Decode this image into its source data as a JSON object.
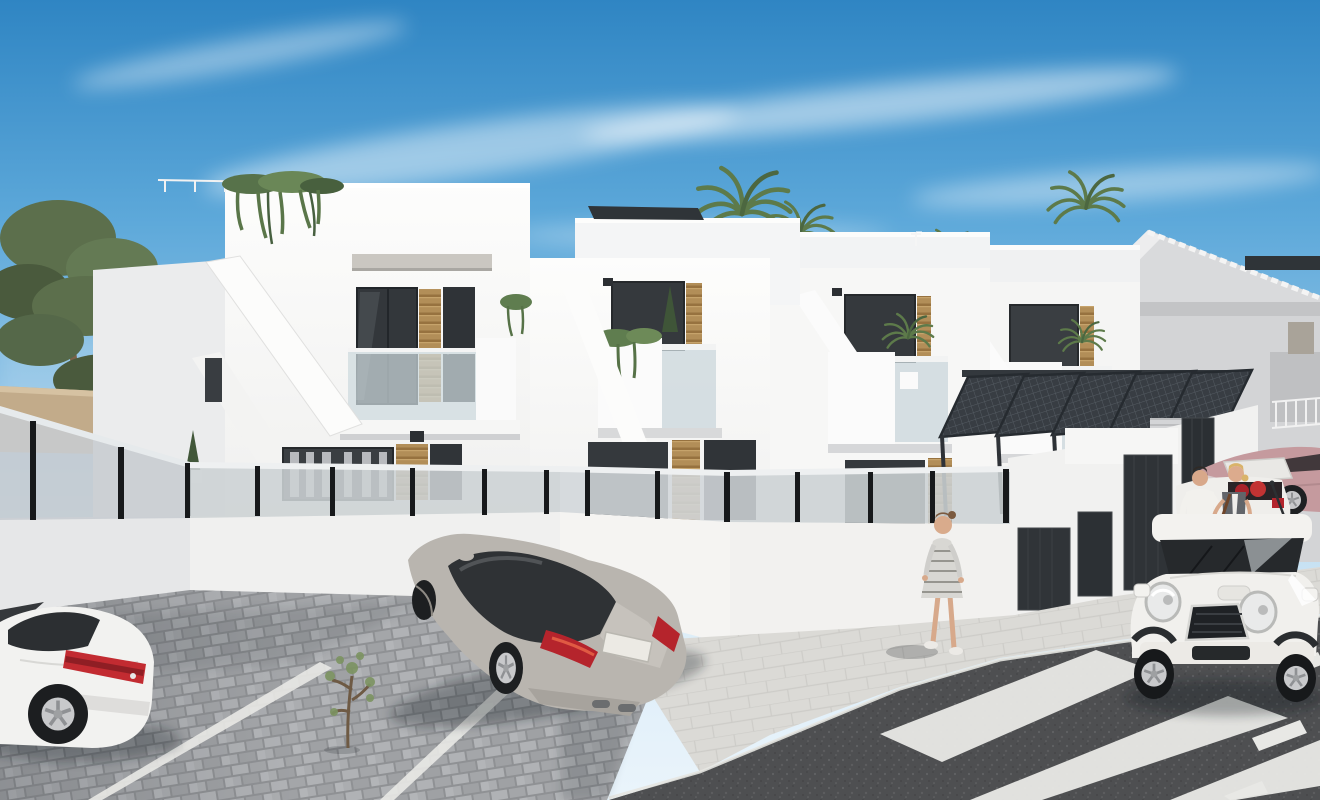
{
  "meta": {
    "domain": "Natural-Image",
    "title": "Photorealistic 3D architectural render: new-build white Mediterranean townhouses, street with parked cars and pedestrians",
    "style": "sunny day CGI exterior visualization",
    "canvas": {
      "width": 1320,
      "height": 800
    }
  },
  "scene": {
    "sky": {
      "description": "clear blue sky with wispy cirrus clouds",
      "top_color": "#2f85c3",
      "mid_color": "#7fb9e2",
      "horizon_color": "#dcedf8"
    },
    "lighting": {
      "sun_direction": "upper right",
      "mood": "bright midday"
    },
    "vegetation": {
      "pine_trees_left": 2,
      "palm_trees_behind_roofs": 4,
      "balcony_plants": [
        "hanging ivy on roof edge",
        "hanging ivy on balcony",
        "potted cypress",
        "potted palms"
      ],
      "street_sapling": 1
    },
    "architecture": {
      "main_corner_house": {
        "storeys": 2,
        "wall_color": "#f8f8f7",
        "features": [
          "roof terrace with ivy",
          "external staircase parapets",
          "glass balustrade balcony",
          "stone lintel",
          "anthracite windows",
          "timber slat panels",
          "curtained ground-floor window"
        ]
      },
      "townhouse_row": {
        "units_visible": 3,
        "wall_color": "#f6f6f5",
        "features": [
          "set-back roof terraces",
          "solar panels",
          "stacked balconies with glass",
          "external stair parapets",
          "timber slat accents",
          "wall lamps"
        ]
      },
      "background_villa_right": {
        "type": "gabled villa",
        "roof_color": "#d9dadc",
        "features": [
          "decorative white ridge",
          "recessed balcony with white railing",
          "shuttered window"
        ]
      },
      "old_village_house_left": {
        "wall_color": "#d8cbb2",
        "roof_color": "#b59a77",
        "boundary_wall": "#c2ab8a"
      },
      "carport_pergolas": {
        "count": 5,
        "color": "#383d43",
        "material": "slanted steel mesh canopies"
      },
      "garage_block": {
        "door_count": 4,
        "door_color": "#2e3236",
        "wall_color": "#f1f1f0"
      },
      "perimeter_fence": {
        "base": "white rendered wall",
        "top": "frosted glass panels",
        "post_color": "#17191b"
      }
    },
    "vehicles": [
      {
        "id": "white-coupe",
        "type": "sports coupe, rear three-quarter view",
        "color": "#f2f2f0",
        "tail_light": "#c22b31",
        "position": "bottom-left parking bay"
      },
      {
        "id": "silver-fastback",
        "type": "luxury fastback sedan seen from behind and above",
        "color": "#b9b5af",
        "tail_light": "#b5242c",
        "license_plate": "blank white",
        "position": "centre parking bay"
      },
      {
        "id": "white-mini",
        "type": "compact hatchback, front view",
        "color": "#f1f0ed",
        "grille": "#1f2225",
        "position": "right, at zebra crossing"
      },
      {
        "id": "white-sedan-open-trunk",
        "type": "white sedan with open boot and red luggage",
        "color": "#efeeeb",
        "position": "right forecourt"
      },
      {
        "id": "rose-fastback",
        "type": "rose/mauve fastback, side view",
        "color": "#c59a9e",
        "position": "far right"
      }
    ],
    "people": [
      {
        "id": "woman-striped-dress",
        "description": "woman in grey-striped dress walking on the pavement",
        "position": "centre-right"
      },
      {
        "id": "man-white-shirt",
        "description": "man in white shirt and dark trousers beside garages",
        "position": "right"
      },
      {
        "id": "woman-blonde-bag",
        "description": "blonde woman with brown shoulder bag at the open boot",
        "position": "right"
      },
      {
        "id": "passerby-head",
        "description": "head of a passer-by just visible above the fence",
        "position": "centre"
      }
    ],
    "ground": {
      "parking_pavers_color": "#a9abae",
      "sidewalk_color": "#dbdad6",
      "asphalt_color": "#4e4f51",
      "zebra_stripe_count": 3,
      "lane_dashes": 3,
      "parking_bay_lines": "white"
    }
  },
  "palette": {
    "white_wall_sunlit": "#fdfdfc",
    "white_wall_front": "#f5f5f4",
    "white_wall_shade": "#e9eaec",
    "window_glass": "#34383c",
    "timber_slats": "#b28e58",
    "stone_lintel": "#cac7c1",
    "frosted_glass": "#ccd1d4",
    "fence_post": "#17191b",
    "pergola_steel": "#383d43",
    "pine_green": "#5c6f4c",
    "palm_green": "#5d7a4a",
    "skin": "#d8a98b",
    "bag_brown": "#8a5b38"
  }
}
